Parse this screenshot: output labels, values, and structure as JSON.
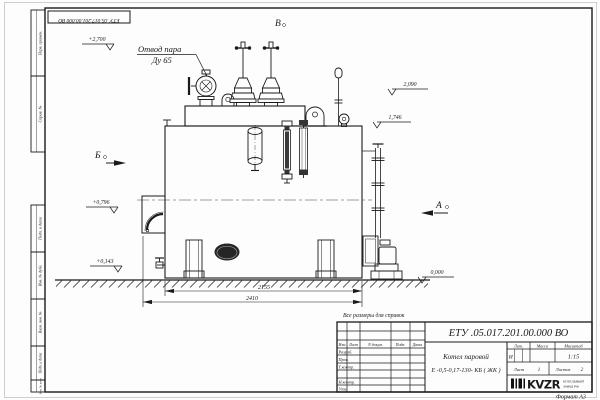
{
  "sheet": {
    "stamp_top": "ЕТУ .05.017.201.00.000  ВО",
    "format_note": "Формат А3",
    "reference_note": "Все размеры для справок"
  },
  "margins": {
    "perv_primen": "Перв. примен.",
    "sprav_no": "Справ. №",
    "podp_data_top": "Подп. и дата",
    "inv_dubl": "Инв. № дубл.",
    "vzam_inv": "Взам. инв. №",
    "podp_data_bottom": "Подп. и дата",
    "inv_podl": "Инв. № подл."
  },
  "drawing": {
    "callout_line1": "Отвод пара",
    "callout_line2": "Ду 65",
    "view_top": "В",
    "view_left": "Б",
    "view_right": "А",
    "elev_2700": "+2,700",
    "elev_2090": "2,090",
    "elev_1746": "1,746",
    "elev_0796": "+0,796",
    "elev_0143": "+0,143",
    "elev_0000": "0,000",
    "dim_2155": "2155",
    "dim_2410": "2410"
  },
  "titleblock": {
    "doc_number": "ЕТУ .05.017.201.00.000  ВО",
    "name_line1": "Котел паровой",
    "name_line2": "Е -0,5-0,17-130- КБ ( ЖК )",
    "col_izm": "Изм",
    "col_list": "Лист",
    "col_ndokum": "N докум.",
    "col_podp": "Подп.",
    "col_data": "Дата",
    "row_razrab": "Разраб.",
    "row_prov": "Пров.",
    "row_tkontr": "Т.контр.",
    "row_nkontr": "Н.контр.",
    "row_utv": "Утв.",
    "lit_label": "Лит.",
    "lit_value": "И",
    "massa_label": "Масса",
    "masshtab_label": "Масштаб",
    "scale": "1:15",
    "sheet_label": "Лист",
    "sheet_value": "1",
    "sheets_label": "Листов",
    "sheets_value": "2",
    "logo_text": "KVZR",
    "logo_sub1": "КОТЕЛЬНЫЙ",
    "logo_sub2": "ЗАВОД РФ"
  }
}
